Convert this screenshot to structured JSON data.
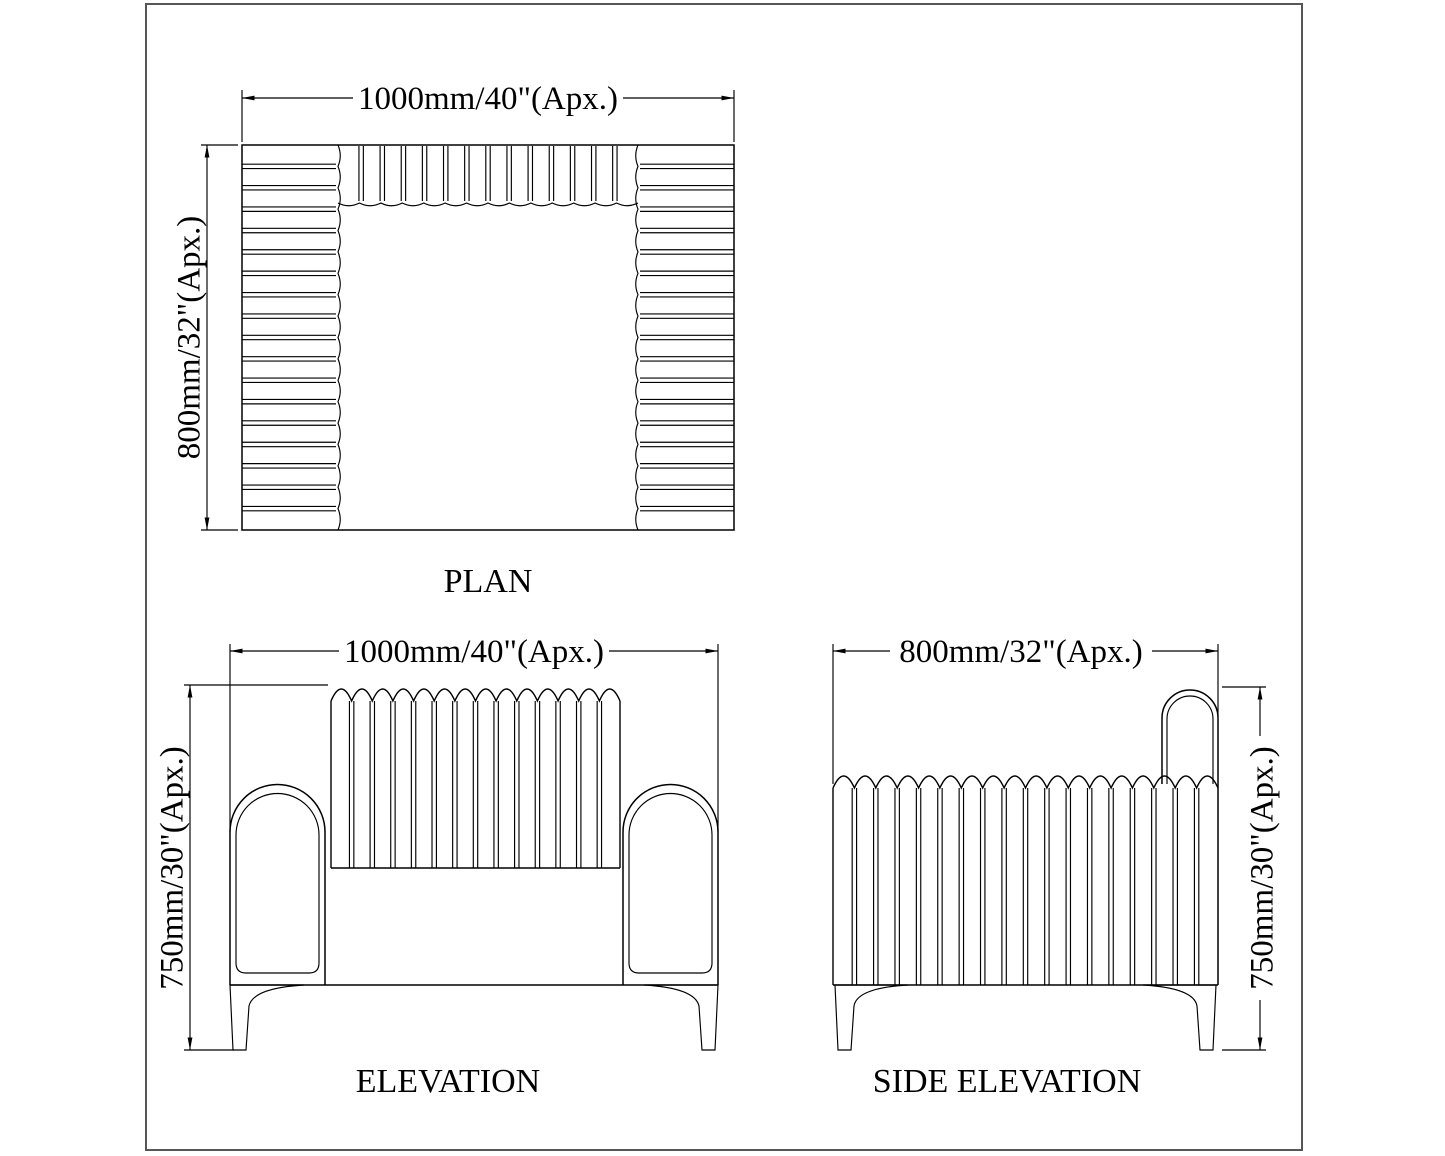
{
  "drawing": {
    "type": "furniture-technical-drawing",
    "views": {
      "plan": {
        "caption": "PLAN",
        "width_dim": "1000mm/40\"(Apx.)",
        "depth_dim": "800mm/32\"(Apx.)"
      },
      "elevation": {
        "caption": "ELEVATION",
        "width_dim": "1000mm/40\"(Apx.)",
        "height_dim": "750mm/30\"(Apx.)"
      },
      "side_elevation": {
        "caption": "SIDE ELEVATION",
        "width_dim": "800mm/32\"(Apx.)",
        "height_dim": "750mm/30\"(Apx.)"
      }
    },
    "colors": {
      "line": "#000000",
      "frame_border": "#565656",
      "background": "#ffffff"
    }
  }
}
